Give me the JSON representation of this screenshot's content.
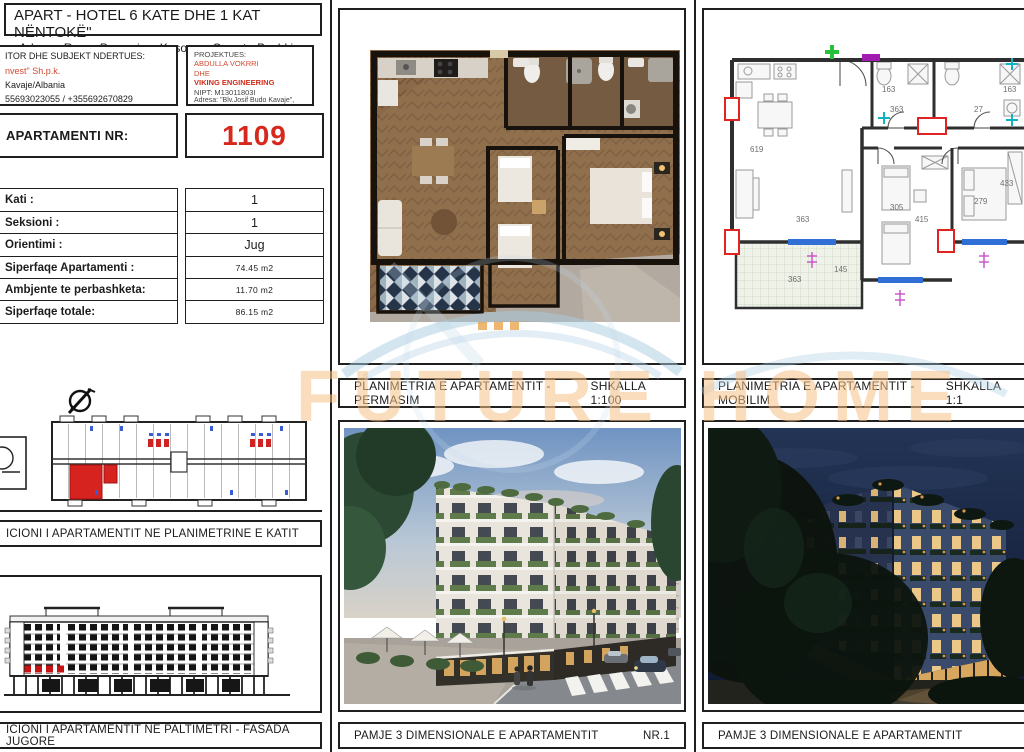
{
  "header": {
    "title": "APART - HOTEL 6 KATE DHE 1 KAT NËNTOKË\"",
    "address": "Adresa: Rruga Pavarsia e Kosoves, Qerret - Bashkia Kavaje"
  },
  "investor": {
    "heading": "ITOR DHE SUBJEKT NDERTUES:",
    "company": "nvest\" Sh.p.k.",
    "location": "Kavaje/Albania",
    "phones": "55693023055 / +355692670829"
  },
  "designer": {
    "heading": "PROJEKTUES:",
    "name1": "ABDULLA VOKRRI",
    "name2": "DHE",
    "name3": "VIKING ENGINEERING",
    "nipt": "NIPT: M13011803I",
    "address": "Adresa: \"Blv.Josif Budo Kavaje\","
  },
  "apartment": {
    "label": "APARTAMENTI NR:",
    "number": "1109",
    "rows": [
      {
        "label": "Kati :",
        "value": "1"
      },
      {
        "label": "Seksioni :",
        "value": "1"
      },
      {
        "label": "Orientimi :",
        "value": "Jug"
      },
      {
        "label": "Siperfaqe Apartamenti :",
        "value": "74.45 m2"
      },
      {
        "label": "Ambjente te perbashketa:",
        "value": "11.70 m2"
      },
      {
        "label": "Siperfaqe totale:",
        "value": "86.15 m2"
      }
    ]
  },
  "panels": {
    "permasim": {
      "title": "PLANIMETRIA E APARTAMENTIT - PERMASIM",
      "scale": "SHKALLA 1:100"
    },
    "mobilim": {
      "title": "PLANIMETRIA E APARTAMENTIT - MOBILIM",
      "scale": "SHKALLA 1:1"
    },
    "position_katit": {
      "title": "ICIONI I APARTAMENTIT NE PLANIMETRINE E KATIT"
    },
    "fasada": {
      "title": "ICIONI I APARTAMENTIT NE PALTIMETRI - FASADA JUGORE"
    },
    "day": {
      "title": "PAMJE 3 DIMENSIONALE E APARTAMENTIT",
      "number": "NR.1"
    },
    "night": {
      "title": "PAMJE 3 DIMENSIONALE E APARTAMENTIT"
    }
  },
  "floorplan": {
    "dims": {
      "bath_left": "163",
      "bath_right": "163",
      "hall_a": "363",
      "hall_b": "27",
      "living_h": "619",
      "living_w": "363",
      "bed_mid_w": "305",
      "bed_mid_h": "415",
      "bed_right_w": "279",
      "bed_right_h": "433",
      "balcony_w": "363",
      "balcony_h": "145"
    }
  },
  "watermark": {
    "text": "FUTURE HOME"
  },
  "colors": {
    "accent_red": "#d6281c",
    "highlight_red": "#e02424",
    "window_blue": "#2f6fd6",
    "watermark_text": "#f6c186",
    "watermark_arc": "#a8cbe0"
  }
}
